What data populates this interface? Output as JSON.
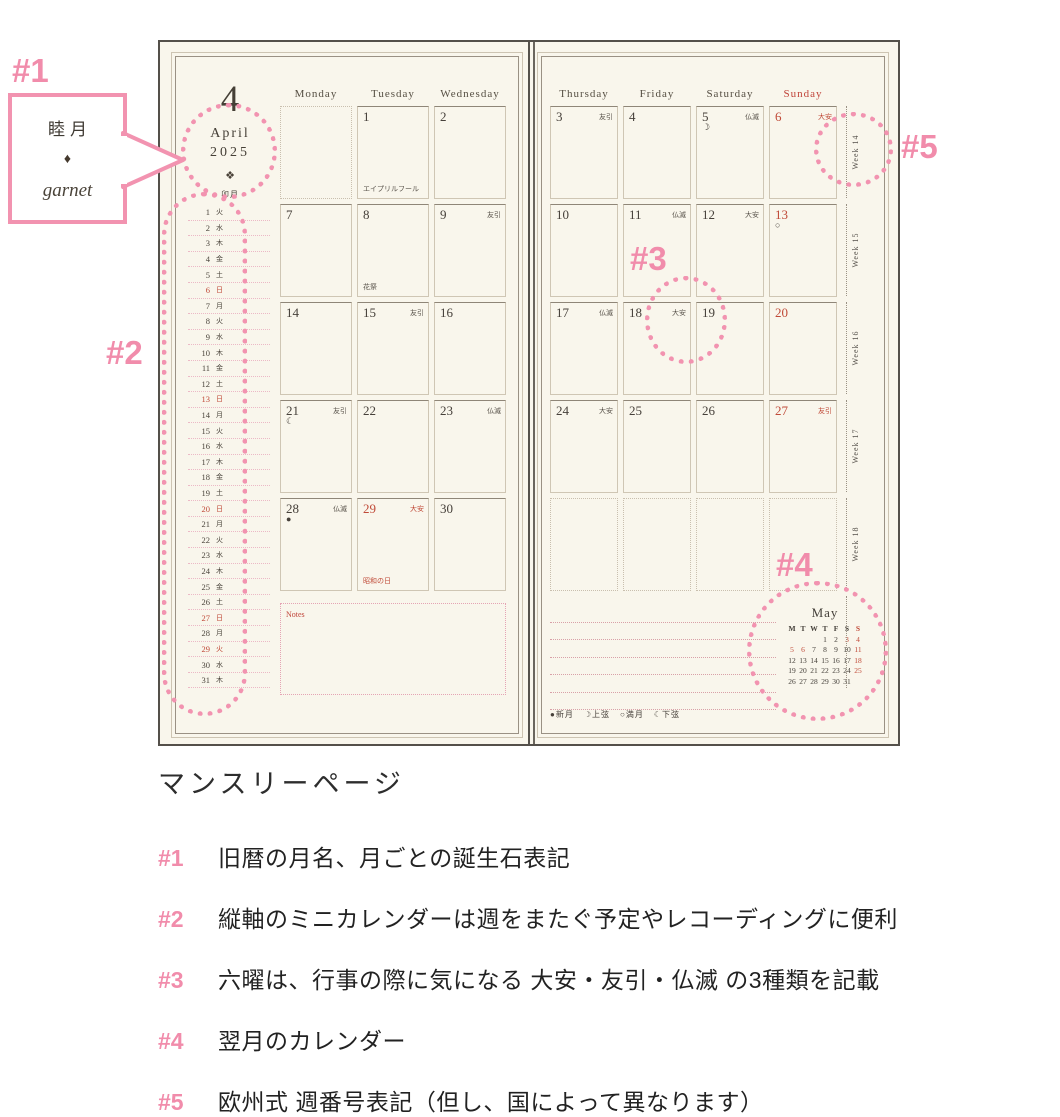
{
  "colors": {
    "pink": "#f293b0",
    "red": "#c04a38",
    "ink": "#46403a",
    "paper": "#f9f6ec",
    "grid_line": "#cfc6b4"
  },
  "callout": {
    "tag": "#1",
    "old_month": "睦月",
    "gem": "♦",
    "birthstone": "garnet"
  },
  "annotations": {
    "tag2": "#2",
    "tag3": "#3",
    "tag4": "#4",
    "tag5": "#5"
  },
  "left_page": {
    "month_number": "4",
    "month_name": "April",
    "year": "2025",
    "birthstone_icon": "❖",
    "old_month_name": "卯月",
    "notes_label": "Notes",
    "day_headers": [
      {
        "label": "Monday"
      },
      {
        "label": "Tuesday"
      },
      {
        "label": "Wednesday"
      }
    ],
    "mini_calendar": [
      {
        "d": "1",
        "w": "火"
      },
      {
        "d": "2",
        "w": "水"
      },
      {
        "d": "3",
        "w": "木"
      },
      {
        "d": "4",
        "w": "金"
      },
      {
        "d": "5",
        "w": "土"
      },
      {
        "d": "6",
        "w": "日",
        "red": true
      },
      {
        "d": "7",
        "w": "月"
      },
      {
        "d": "8",
        "w": "火"
      },
      {
        "d": "9",
        "w": "水"
      },
      {
        "d": "10",
        "w": "木"
      },
      {
        "d": "11",
        "w": "金"
      },
      {
        "d": "12",
        "w": "土"
      },
      {
        "d": "13",
        "w": "日",
        "red": true
      },
      {
        "d": "14",
        "w": "月"
      },
      {
        "d": "15",
        "w": "火"
      },
      {
        "d": "16",
        "w": "水"
      },
      {
        "d": "17",
        "w": "木"
      },
      {
        "d": "18",
        "w": "金"
      },
      {
        "d": "19",
        "w": "土"
      },
      {
        "d": "20",
        "w": "日",
        "red": true
      },
      {
        "d": "21",
        "w": "月"
      },
      {
        "d": "22",
        "w": "火"
      },
      {
        "d": "23",
        "w": "水"
      },
      {
        "d": "24",
        "w": "木"
      },
      {
        "d": "25",
        "w": "金"
      },
      {
        "d": "26",
        "w": "土"
      },
      {
        "d": "27",
        "w": "日",
        "red": true
      },
      {
        "d": "28",
        "w": "月"
      },
      {
        "d": "29",
        "w": "火",
        "red": true
      },
      {
        "d": "30",
        "w": "水"
      },
      {
        "d": "31",
        "w": "木"
      }
    ],
    "rows": [
      [
        {
          "empty": true
        },
        {
          "num": "1",
          "note": "エイプリルフール"
        },
        {
          "num": "2"
        }
      ],
      [
        {
          "num": "7"
        },
        {
          "num": "8",
          "note": "花祭"
        },
        {
          "num": "9",
          "rokuyo": "友引"
        }
      ],
      [
        {
          "num": "14"
        },
        {
          "num": "15",
          "rokuyo": "友引"
        },
        {
          "num": "16"
        }
      ],
      [
        {
          "num": "21",
          "rokuyo": "友引",
          "moon": "☾"
        },
        {
          "num": "22"
        },
        {
          "num": "23",
          "rokuyo": "仏滅"
        }
      ],
      [
        {
          "num": "28",
          "rokuyo": "仏滅",
          "moon": "●"
        },
        {
          "num": "29",
          "red": true,
          "rokuyo": "大安",
          "note": "昭和の日",
          "note_red": true
        },
        {
          "num": "30"
        }
      ]
    ]
  },
  "right_page": {
    "day_headers": [
      {
        "label": "Thursday"
      },
      {
        "label": "Friday"
      },
      {
        "label": "Saturday"
      },
      {
        "label": "Sunday",
        "red": true
      }
    ],
    "rows": [
      [
        {
          "num": "3",
          "rokuyo": "友引"
        },
        {
          "num": "4"
        },
        {
          "num": "5",
          "rokuyo": "仏滅",
          "moon": "☽"
        },
        {
          "num": "6",
          "red": true,
          "rokuyo": "大安"
        }
      ],
      [
        {
          "num": "10"
        },
        {
          "num": "11",
          "rokuyo": "仏滅"
        },
        {
          "num": "12",
          "rokuyo": "大安"
        },
        {
          "num": "13",
          "red": true,
          "moon": "○"
        }
      ],
      [
        {
          "num": "17",
          "rokuyo": "仏滅"
        },
        {
          "num": "18",
          "rokuyo": "大安"
        },
        {
          "num": "19"
        },
        {
          "num": "20",
          "red": true
        }
      ],
      [
        {
          "num": "24",
          "rokuyo": "大安"
        },
        {
          "num": "25"
        },
        {
          "num": "26"
        },
        {
          "num": "27",
          "red": true,
          "rokuyo": "友引"
        }
      ],
      [
        {
          "empty": true
        },
        {
          "empty": true
        },
        {
          "empty": true
        },
        {
          "empty": true
        }
      ]
    ],
    "week_labels": [
      "Week 14",
      "Week 15",
      "Week 16",
      "Week 17",
      "Week 18",
      ""
    ],
    "ruled_line_count": 6,
    "moon_legend": [
      {
        "symbol": "●",
        "label": "新月"
      },
      {
        "symbol": "☽",
        "label": "上弦"
      },
      {
        "symbol": "○",
        "label": "満月"
      },
      {
        "symbol": "☾",
        "label": "下弦"
      }
    ],
    "next_month": {
      "title": "May",
      "day_letters": [
        "M",
        "T",
        "W",
        "T",
        "F",
        "S",
        "S"
      ],
      "weeks": [
        [
          "",
          "",
          "",
          "1",
          "2",
          "3",
          "4"
        ],
        [
          "5",
          "6",
          "7",
          "8",
          "9",
          "10",
          "11"
        ],
        [
          "12",
          "13",
          "14",
          "15",
          "16",
          "17",
          "18"
        ],
        [
          "19",
          "20",
          "21",
          "22",
          "23",
          "24",
          "25"
        ],
        [
          "26",
          "27",
          "28",
          "29",
          "30",
          "31",
          ""
        ]
      ],
      "red_numbers": [
        "3",
        "4",
        "5",
        "6",
        "11",
        "18",
        "25"
      ]
    }
  },
  "caption": {
    "title": "マンスリーページ",
    "items": [
      {
        "tag": "#1",
        "text": "旧暦の月名、月ごとの誕生石表記"
      },
      {
        "tag": "#2",
        "text": "縦軸のミニカレンダーは週をまたぐ予定やレコーディングに便利"
      },
      {
        "tag": "#3",
        "text": "六曜は、行事の際に気になる 大安・友引・仏滅 の3種類を記載"
      },
      {
        "tag": "#4",
        "text": "翌月のカレンダー"
      },
      {
        "tag": "#5",
        "text": "欧州式 週番号表記（但し、国によって異なります）"
      }
    ]
  }
}
